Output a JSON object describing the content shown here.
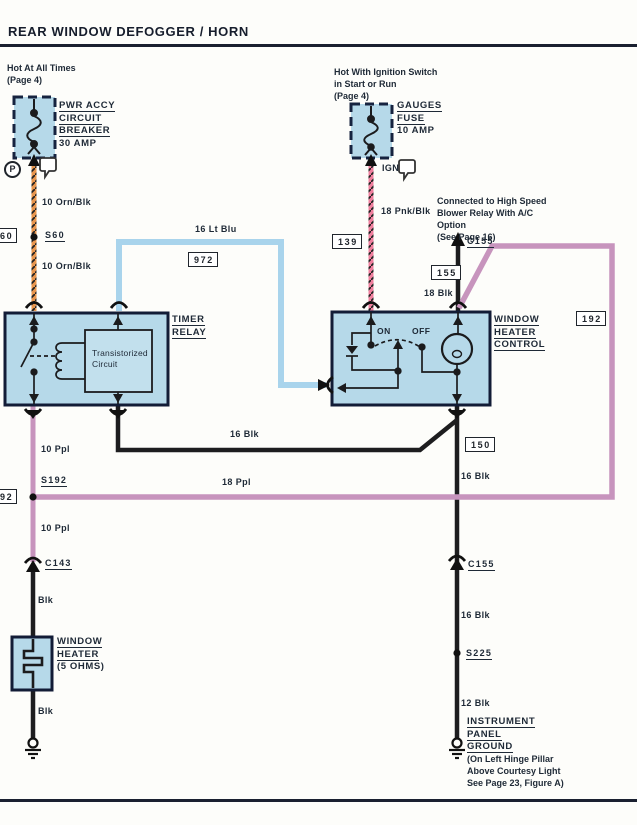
{
  "header": {
    "title": "REAR WINDOW DEFOGGER / HORN"
  },
  "breaker": {
    "note1": "Hot At All Times",
    "note2": "(Page 4)",
    "name1": "PWR ACCY",
    "name2": "CIRCUIT",
    "name3": "BREAKER",
    "rating": "30 AMP",
    "terminal_p": "P"
  },
  "fuse": {
    "note1": "Hot With Ignition Switch",
    "note2": "in Start or Run",
    "note3": "(Page 4)",
    "name1": "GAUGES",
    "name2": "FUSE",
    "rating": "10 AMP",
    "terminal_ign": "IGN"
  },
  "blower_note": {
    "l1": "Connected to High Speed",
    "l2": "Blower Relay With A/C",
    "l3": "Option",
    "l4": "(See Page 16)"
  },
  "timer_relay": {
    "name1": "TIMER",
    "name2": "RELAY",
    "inner1": "Transistorized",
    "inner2": "Circuit"
  },
  "heater_control": {
    "name1": "WINDOW",
    "name2": "HEATER",
    "name3": "CONTROL",
    "on": "ON",
    "off": "OFF"
  },
  "window_heater": {
    "name1": "WINDOW",
    "name2": "HEATER",
    "name3": "(5 OHMS)"
  },
  "ground_right": {
    "name1": "INSTRUMENT",
    "name2": "PANEL",
    "name3": "GROUND",
    "note1": "(On Left Hinge Pillar",
    "note2": "Above Courtesy Light",
    "note3": "See Page 23, Figure A)"
  },
  "wire_labels": {
    "orn_upper": "10 Orn/Blk",
    "orn_lower": "10 Orn/Blk",
    "pnk": "18 Pnk/Blk",
    "lt_blu": "16 Lt Blu",
    "blk18": "18 Blk",
    "blk16_mid": "16 Blk",
    "ppl10_upper": "10 Ppl",
    "ppl18": "18 Ppl",
    "ppl10_lower": "10 Ppl",
    "blk_upper": "Blk",
    "blk_lower": "Blk",
    "blk16_upper": "16 Blk",
    "blk16_lower": "16 Blk",
    "blk12": "12 Blk"
  },
  "connectors": {
    "s60": "S60",
    "s192": "S192",
    "c143": "C143",
    "c155_top": "C155",
    "c155_mid": "C155",
    "s225": "S225"
  },
  "ref_boxes": {
    "left_60": "60",
    "b972": "972",
    "b139": "139",
    "b155": "155",
    "b150": "150",
    "b192": "192",
    "left_92": "92"
  },
  "colors": {
    "wire_orange": "#e8964e",
    "wire_pink": "#f07f9e",
    "wire_lt_blue": "#a9d4ec",
    "wire_purple": "#c794bd",
    "wire_black": "#1d1d1f",
    "component_fill": "#b6d9e9",
    "border_dark": "#16233f",
    "text": "#1e2936"
  }
}
